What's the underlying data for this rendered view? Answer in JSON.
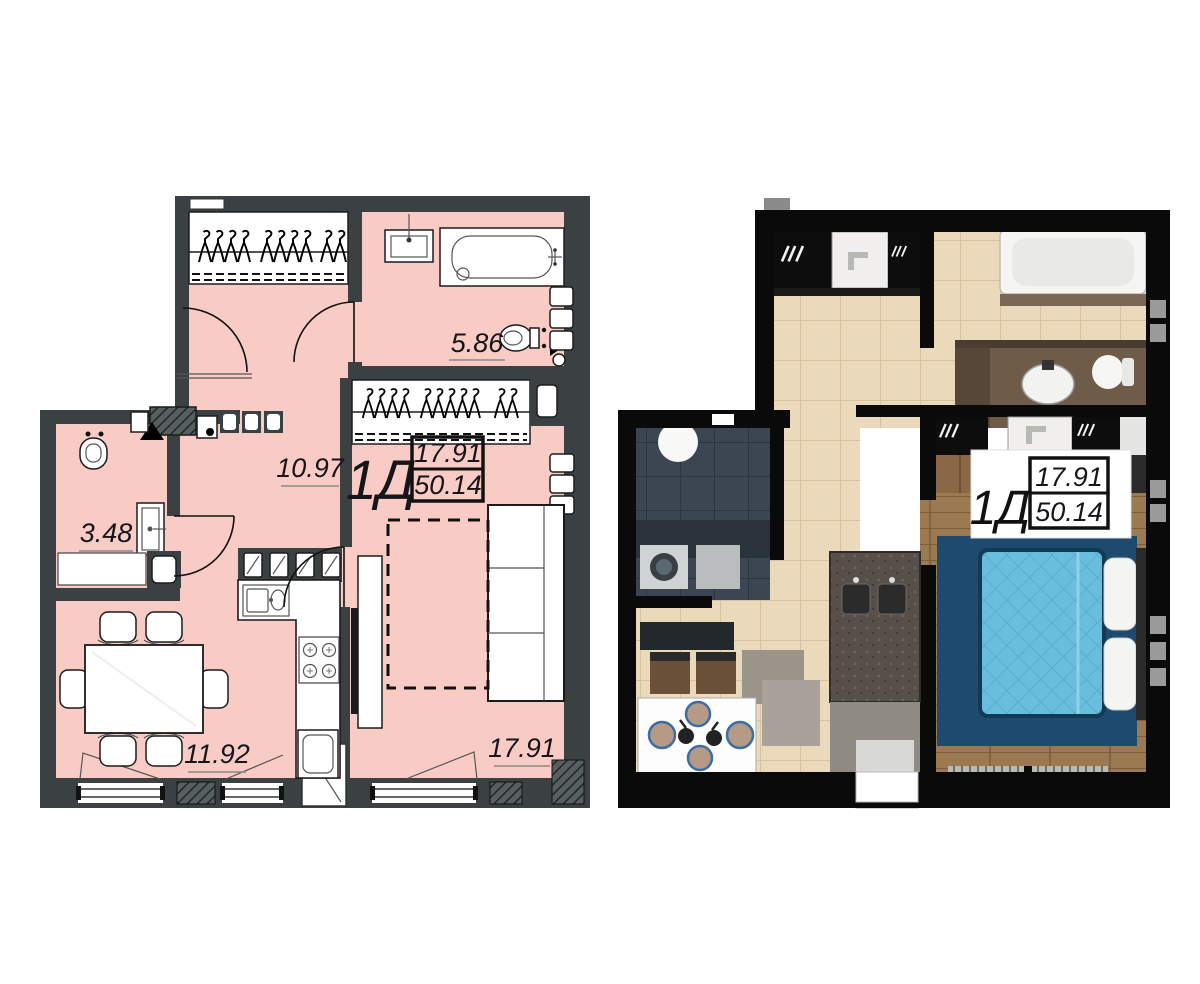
{
  "page": {
    "width": 1200,
    "height": 984,
    "background": "#ffffff"
  },
  "unit": {
    "type_label": "1Д",
    "living_area": "17.91",
    "total_area": "50.14"
  },
  "plan_2d": {
    "style": "2d-blueprint-floor-plan",
    "colors": {
      "room_fill": "#f8ccc5",
      "wall": "#3b4142",
      "line": "#1c1c1c"
    },
    "rooms": [
      {
        "id": "bathroom",
        "area": "5.86"
      },
      {
        "id": "hallway",
        "area": "10.97"
      },
      {
        "id": "wc",
        "area": "3.48"
      },
      {
        "id": "kitchen-dining",
        "area": "11.92"
      },
      {
        "id": "living-room",
        "area": "17.91"
      }
    ]
  },
  "plan_3d": {
    "style": "3d-render-floor-plan",
    "colors": {
      "wall": "#0a0a0a",
      "tile_floor": "#ead9bb",
      "wc_floor": "#3b4652",
      "wood_floor": "#9b7a52",
      "wardrobe_wood": "#8a6847",
      "vanity_counter": "#6e5b48",
      "rug": "#1d4a6e",
      "bed": "#69bedd",
      "pillow": "#f4f4f2",
      "table": "#fdfdfd",
      "plate": "#b59a85"
    }
  }
}
